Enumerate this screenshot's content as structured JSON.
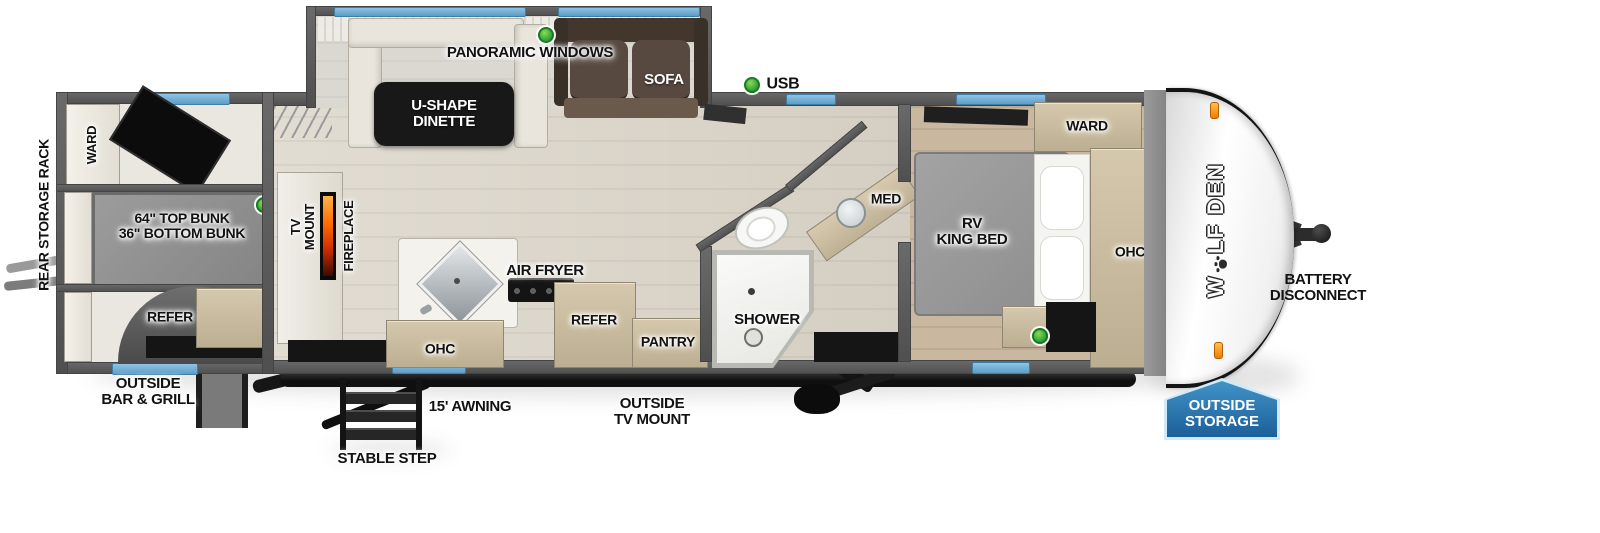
{
  "colors": {
    "window_blue": "#6fb3e0",
    "led_green": "#3cae49",
    "badge_blue": "#2b7db8",
    "flame_orange": "#ff6a00"
  },
  "brand": {
    "left": "W",
    "right": "LF DEN"
  },
  "exterior": {
    "rear_storage_rack": "REAR STORAGE RACK",
    "outside_bar_grill": "OUTSIDE\nBAR & GRILL",
    "stable_step": "STABLE STEP",
    "awning": "15' AWNING",
    "outside_tv_mount": "OUTSIDE\nTV MOUNT",
    "outside_storage": "OUTSIDE\nSTORAGE",
    "battery_disconnect": "BATTERY\nDISCONNECT",
    "usb": "USB",
    "panoramic_windows": "PANORAMIC WINDOWS"
  },
  "rooms": {
    "bunk": {
      "ward": "WARD",
      "bunk_label": "64\" TOP BUNK\n36\" BOTTOM BUNK",
      "refer": "REFER"
    },
    "living": {
      "dinette": "U-SHAPE\nDINETTE",
      "sofa": "SOFA",
      "tv_mount": "TV\nMOUNT",
      "fireplace": "FIREPLACE"
    },
    "kitchen": {
      "air_fryer": "AIR FRYER",
      "ohc": "OHC",
      "refer": "REFER",
      "pantry": "PANTRY"
    },
    "bath": {
      "shower": "SHOWER",
      "med": "MED"
    },
    "bedroom": {
      "bed": "RV\nKING BED",
      "ward": "WARD",
      "ohc": "OHC"
    }
  }
}
